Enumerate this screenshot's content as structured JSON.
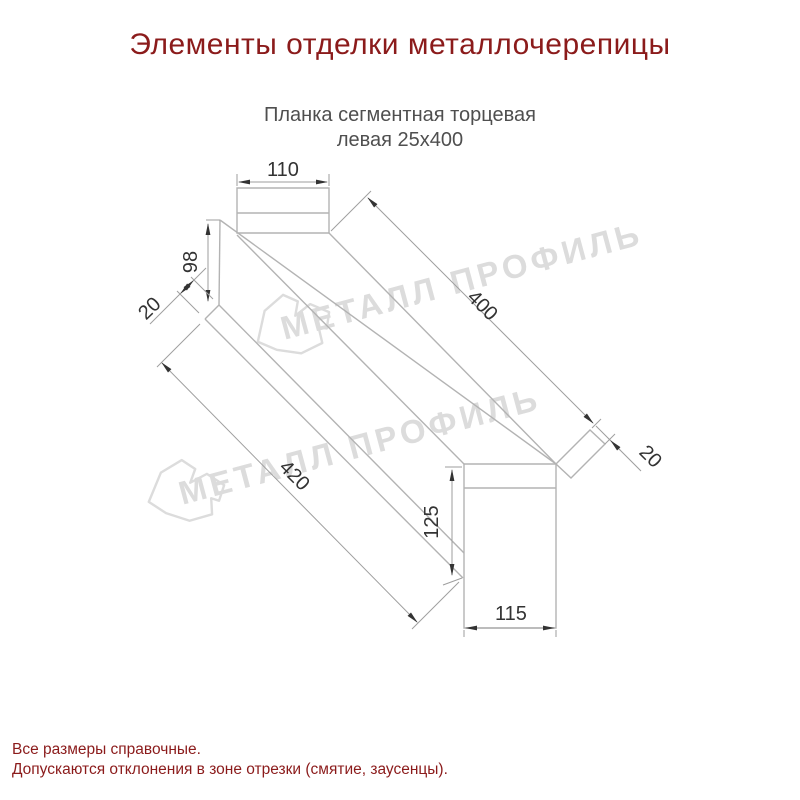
{
  "page": {
    "title": "Элементы отделки металлочерепицы"
  },
  "product": {
    "subtitle_line1": "Планка сегментная торцевая",
    "subtitle_line2": "левая 25х400"
  },
  "dimensions": {
    "top_width": "110",
    "left_height": "98",
    "left_fold": "20",
    "slope_length": "400",
    "right_fold": "20",
    "front_length": "420",
    "end_height": "125",
    "bottom_width": "115"
  },
  "watermark": {
    "text": "МЕТАЛЛ ПРОФИЛЬ"
  },
  "footer": {
    "line1": "Все размеры справочные.",
    "line2": "Допускаются отклонения в зоне отрезки (смятие, заусенцы)."
  },
  "colors": {
    "accent_title": "#8b1b1b",
    "footer_text": "#8b1b1b",
    "subtitle_text": "#4f4f4f",
    "drawing_line": "#b3b3b3",
    "dimension_line": "#9e9e9e",
    "dimension_text": "#333333",
    "watermark": "#dcdcdc"
  }
}
